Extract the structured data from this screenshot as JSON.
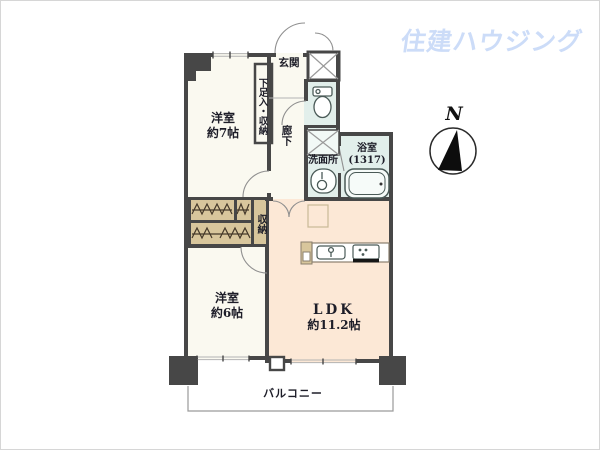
{
  "logo": {
    "text": "住建ハウジング",
    "color": "#ccdcf8"
  },
  "compass": {
    "label": "N"
  },
  "rooms": {
    "western7": {
      "label": "洋室",
      "size": "約7帖"
    },
    "shoe_storage": {
      "label": "下足入・収納"
    },
    "entrance": {
      "label": "玄関"
    },
    "hallway": {
      "label": "廊下"
    },
    "washroom": {
      "label": "洗面所"
    },
    "bathroom": {
      "label": "浴室",
      "size": "(1317)"
    },
    "closet": {
      "label": "収納"
    },
    "western6": {
      "label": "洋室",
      "size": "約6帖"
    },
    "ldk": {
      "label": "LDK",
      "size": "約11.2帖"
    },
    "balcony": {
      "label": "バルコニー"
    }
  },
  "colors": {
    "wall": "#474747",
    "room_floor": "#faf9f0",
    "wet_area": "#e2efeb",
    "closet": "#d8c69c",
    "ldk_floor": "#fce8d6",
    "logo_blue": "#ccdcf8"
  }
}
